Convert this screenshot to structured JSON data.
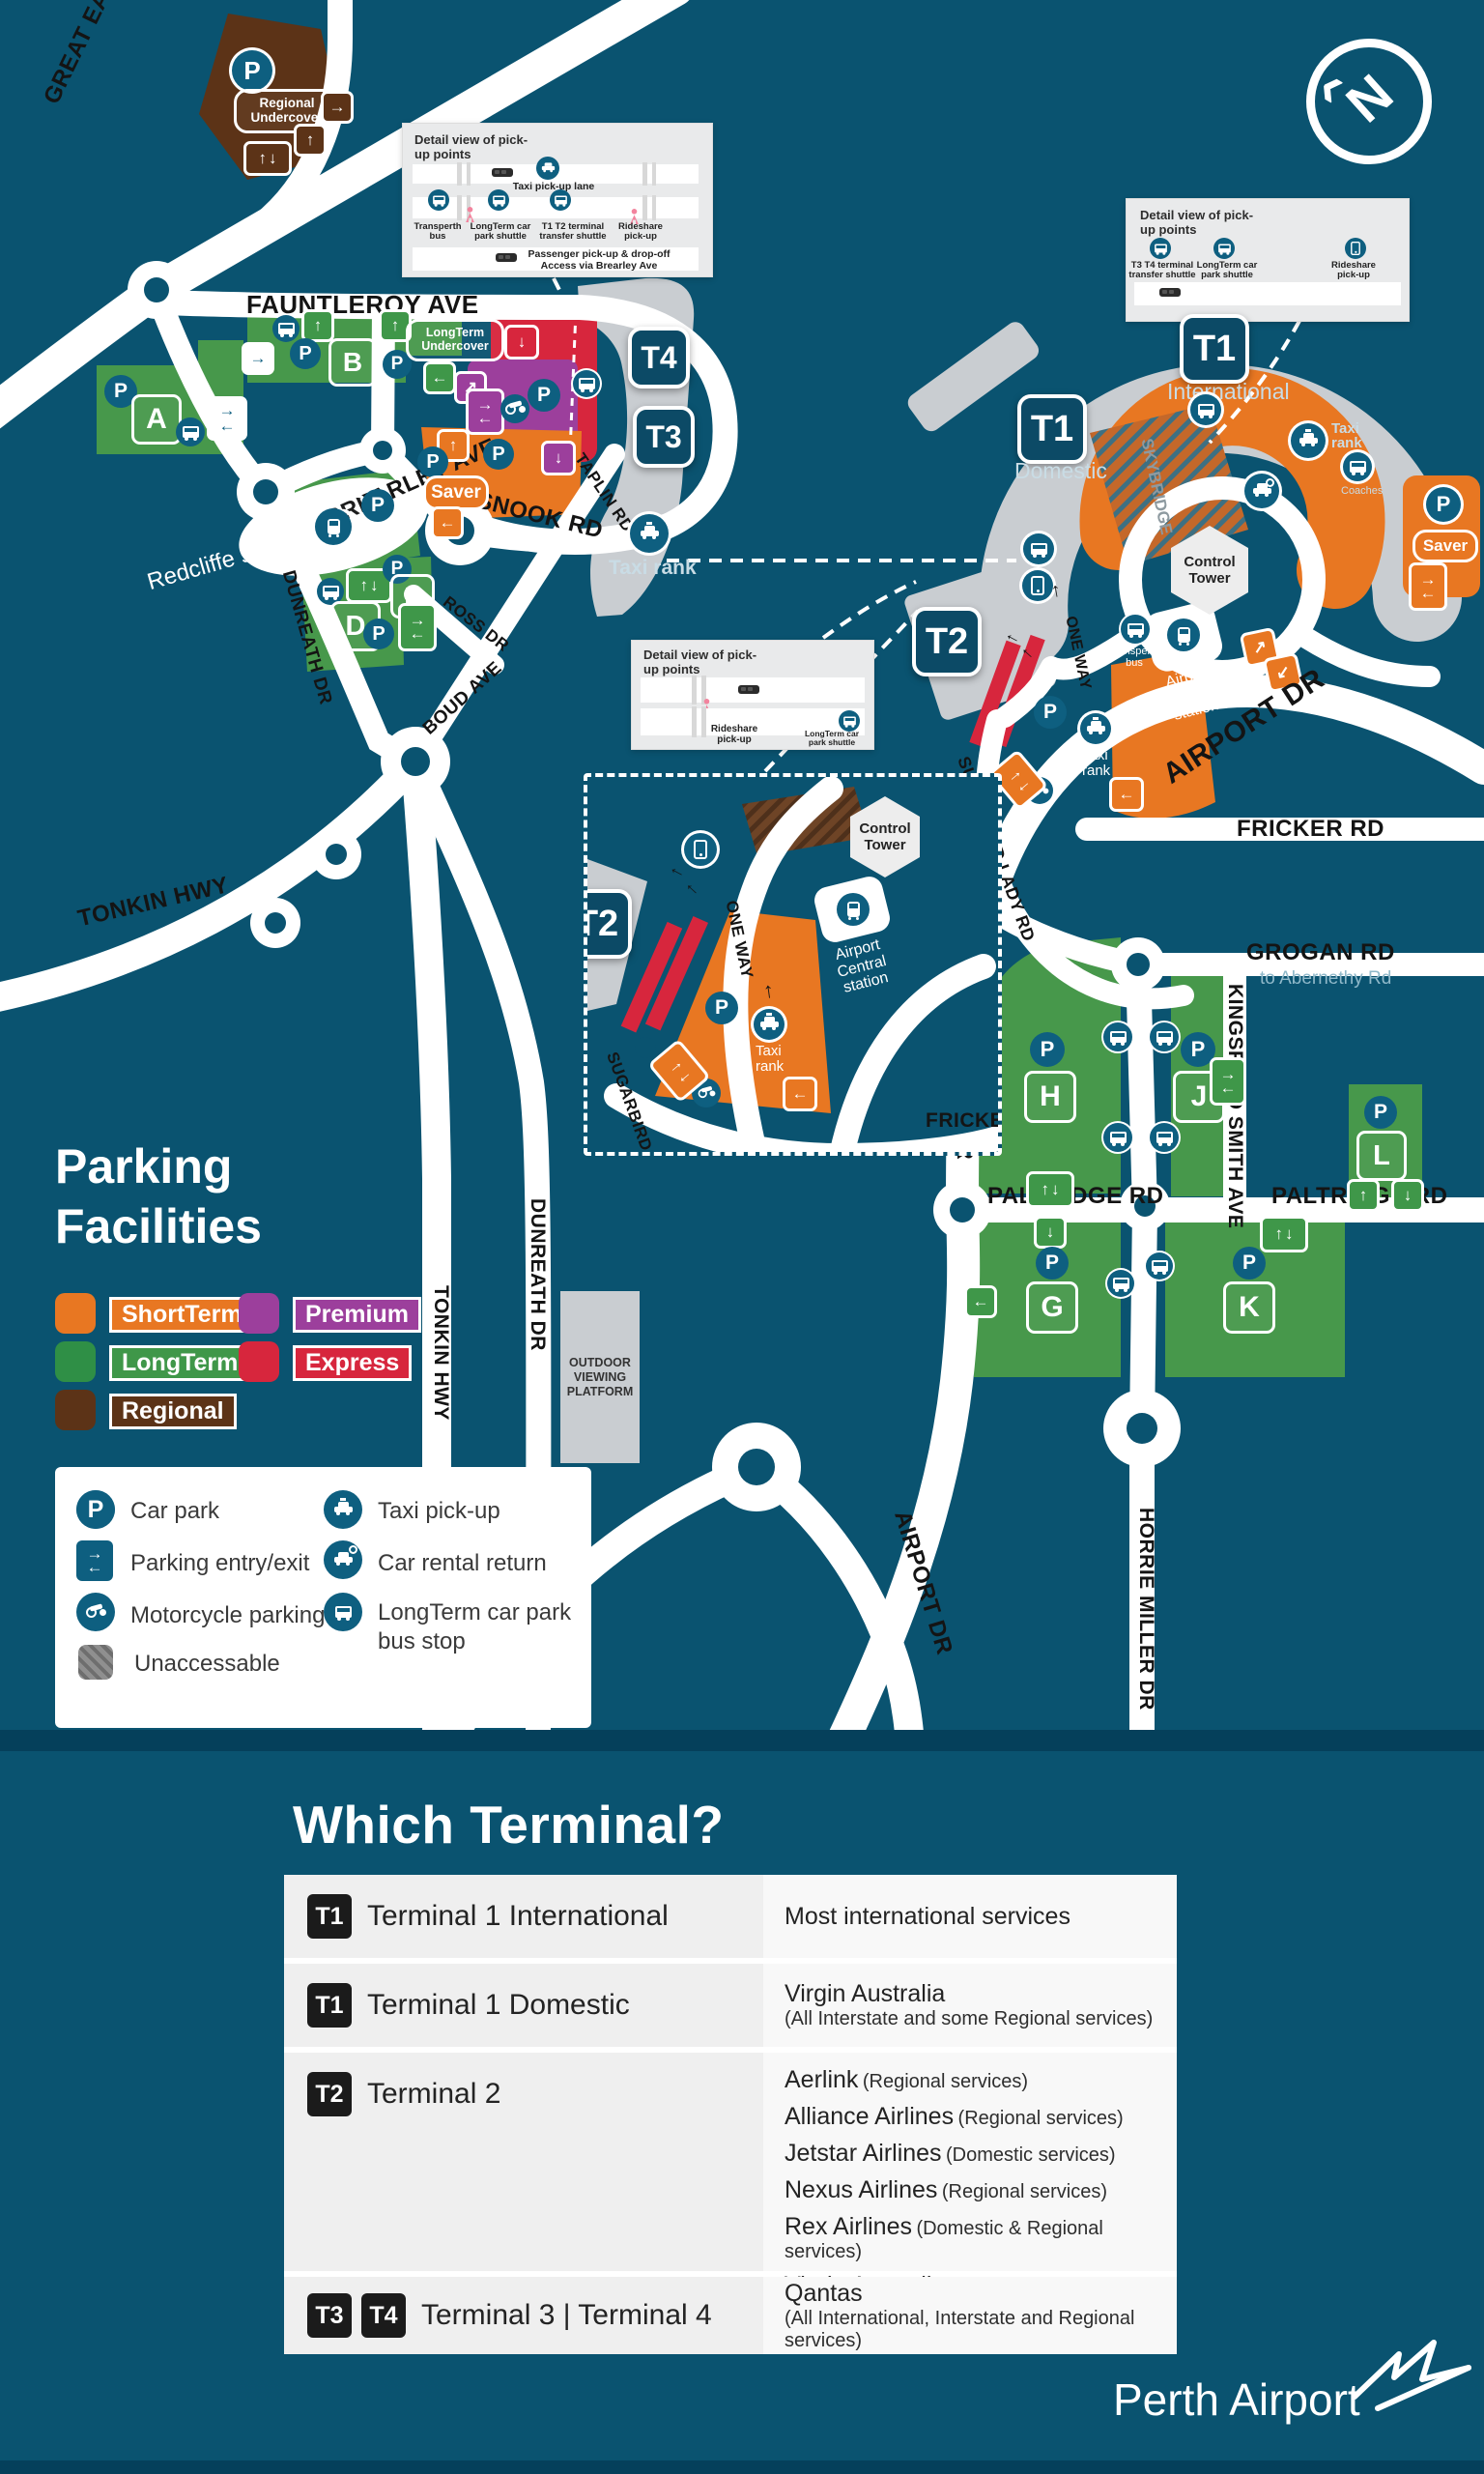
{
  "colors": {
    "background": "#0A5370",
    "band": "#05405B",
    "road": "#FFFFFF",
    "short_term": "#E87722",
    "long_term_area": "#47984B",
    "long_term_swatch": "#2F8F46",
    "premium": "#9C3F9C",
    "express": "#D7263D",
    "regional": "#5C3317",
    "terminal_gray": "#C9CDD1",
    "icon_teal": "#0E5F80",
    "table_badge": "#1B1B1B"
  },
  "icons": {
    "p": "P",
    "up": "↑",
    "down": "↓",
    "left": "←",
    "right": "→",
    "upright": "↗",
    "downleft": "↙",
    "north": "N",
    "northptr": "‹"
  },
  "map": {
    "roads": {
      "great_eastern": "GREAT EASTERN HWY",
      "fauntleroy": "FAUNTLEROY AVE",
      "brearley": "BREARLEY AVE",
      "snook": "SNOOK RD",
      "taplin": "TAPLIN RD",
      "ross": "ROSS DR",
      "boud": "BOUD AVE",
      "dunreath": "DUNREATH DR",
      "tonkin": "TONKIN HWY",
      "airport": "AIRPORT DR",
      "sugarbird": "SUGARBIRD LADY RD",
      "fricker": "FRICKER RD",
      "grogan": "GROGAN RD",
      "grogan_sub": "to Abernethy Rd",
      "kingsford": "KINGSFORD SMITH AVE",
      "paltridge": "PALTRIDGE RD",
      "horrie": "HORRIE MILLER DR",
      "one_way": "ONE WAY",
      "skybridge": "SKYBRIDGE"
    },
    "places": {
      "redcliffe": "Redcliffe station",
      "airport_central": "Airport Central station",
      "control_tower": "Control Tower",
      "taxi_rank": "Taxi rank",
      "coaches": "Coaches",
      "transperth_bus": "Transperth bus",
      "platform": "OUTDOOR VIEWING PLATFORM",
      "t1_international": "International",
      "t1_domestic": "Domestic"
    },
    "terminals": {
      "t1": "T1",
      "t2": "T2",
      "t3": "T3",
      "t4": "T4"
    },
    "car_parks": {
      "a": "A",
      "b": "B",
      "c": "C",
      "d": "D",
      "e": "E",
      "g": "G",
      "h": "H",
      "j": "J",
      "k": "K",
      "l": "L",
      "saver": "Saver",
      "regional_undercover": "Regional Undercover",
      "longterm_undercover": "LongTerm Undercover"
    },
    "detail1": {
      "title": "Detail view of pick-up points",
      "taxi_lane": "Taxi pick-up lane",
      "transper": "Transperth bus",
      "longterm_shuttle": "LongTerm car park shuttle",
      "t1t2_shuttle": "T1 T2 terminal transfer shuttle",
      "rideshare": "Rideshare pick-up",
      "passenger": "Passenger pick-up & drop-off",
      "access": "Access via Brearley Ave"
    },
    "detail2": {
      "title": "Detail view of pick-up points",
      "t3t4_shuttle": "T3 T4 terminal transfer shuttle",
      "longterm_shuttle": "LongTerm car park shuttle",
      "rideshare": "Rideshare pick-up"
    },
    "detail3": {
      "title": "Detail view of pick-up points",
      "rideshare": "Rideshare pick-up",
      "longterm_shuttle": "LongTerm car park shuttle"
    }
  },
  "parking_legend": {
    "title1": "Parking",
    "title2": "Facilities",
    "items": [
      {
        "label": "ShortTerm",
        "color": "#E87722"
      },
      {
        "label": "Premium",
        "color": "#9C3F9C"
      },
      {
        "label": "LongTerm",
        "color": "#2F8F46"
      },
      {
        "label": "Express",
        "color": "#D7263D"
      },
      {
        "label": "Regional",
        "color": "#5C3317"
      }
    ]
  },
  "legend": {
    "items": [
      {
        "label": "Car park"
      },
      {
        "label": "Parking entry/exit"
      },
      {
        "label": "Motorcycle parking"
      },
      {
        "label": "Unaccessable"
      },
      {
        "label": "Taxi pick-up"
      },
      {
        "label": "Car rental return"
      },
      {
        "label": "LongTerm car park bus stop"
      }
    ]
  },
  "which_terminal": {
    "title": "Which Terminal?",
    "rows": [
      {
        "badges": [
          "T1"
        ],
        "name": "Terminal 1 International",
        "services": [
          {
            "main": "Most international services",
            "sub": ""
          }
        ]
      },
      {
        "badges": [
          "T1"
        ],
        "name": "Terminal 1 Domestic",
        "services": [
          {
            "main": "Virgin Australia",
            "sub": "(All Interstate and some Regional services)"
          }
        ]
      },
      {
        "badges": [
          "T2"
        ],
        "name": "Terminal 2",
        "services": [
          {
            "main": "Aerlink",
            "sub": "(Regional services)"
          },
          {
            "main": "Alliance Airlines",
            "sub": "(Regional services)"
          },
          {
            "main": "Jetstar Airlines",
            "sub": "(Domestic services)"
          },
          {
            "main": "Nexus Airlines",
            "sub": "(Regional services)"
          },
          {
            "main": "Rex Airlines",
            "sub": "(Domestic & Regional services)"
          },
          {
            "main": "Virgin Australia",
            "sub": "(Most Regional services)"
          }
        ]
      },
      {
        "badges": [
          "T3",
          "T4"
        ],
        "name": "Terminal 3 | Terminal 4",
        "services": [
          {
            "main": "Qantas",
            "sub": "(All International, Interstate and Regional services)"
          }
        ]
      }
    ]
  },
  "footer": {
    "brand": "Perth Airport"
  }
}
